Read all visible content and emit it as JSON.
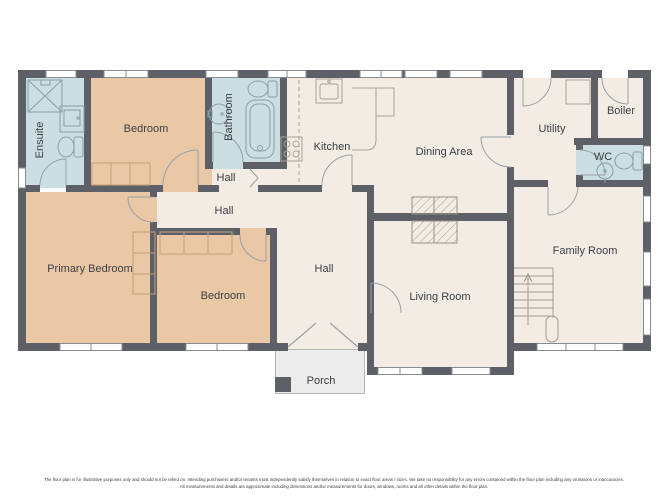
{
  "floor_plan": {
    "rooms": [
      {
        "name": "ensuite",
        "label": "Ensuite"
      },
      {
        "name": "bedroom-top",
        "label": "Bedroom"
      },
      {
        "name": "bathroom",
        "label": "Bathroom"
      },
      {
        "name": "hall-small",
        "label": "Hall"
      },
      {
        "name": "kitchen",
        "label": "Kitchen"
      },
      {
        "name": "dining-area",
        "label": "Dining Area"
      },
      {
        "name": "utility",
        "label": "Utility"
      },
      {
        "name": "boiler",
        "label": "Boiler"
      },
      {
        "name": "wc",
        "label": "WC"
      },
      {
        "name": "hall-upper",
        "label": "Hall"
      },
      {
        "name": "primary-bedroom",
        "label": "Primary Bedroom"
      },
      {
        "name": "bedroom-bottom",
        "label": "Bedroom"
      },
      {
        "name": "hall-lower",
        "label": "Hall"
      },
      {
        "name": "living-room",
        "label": "Living Room"
      },
      {
        "name": "family-room",
        "label": "Family Room"
      },
      {
        "name": "porch",
        "label": "Porch"
      }
    ],
    "colors": {
      "wall": "#5d6167",
      "room_default": "#f2ece4",
      "bedroom_fill": "#eac7a5",
      "wet_room_fill": "#cbdee1",
      "porch_fill": "#ececec",
      "label_text": "#3c4045"
    },
    "footer": {
      "line1": "The floor plan is for illustrative purposes only and should not be relied on. Intending purchasers and/or tenants must independently satisfy themselves in relation to exact floor areas / sizes. We take no responsibility for any errors contained within the floor plan including any omissions or inaccuracies.",
      "line2": "All measurements and details are approximate including dimensions and/or measurements for doors, windows, rooms and all other details within the floor plan."
    }
  }
}
